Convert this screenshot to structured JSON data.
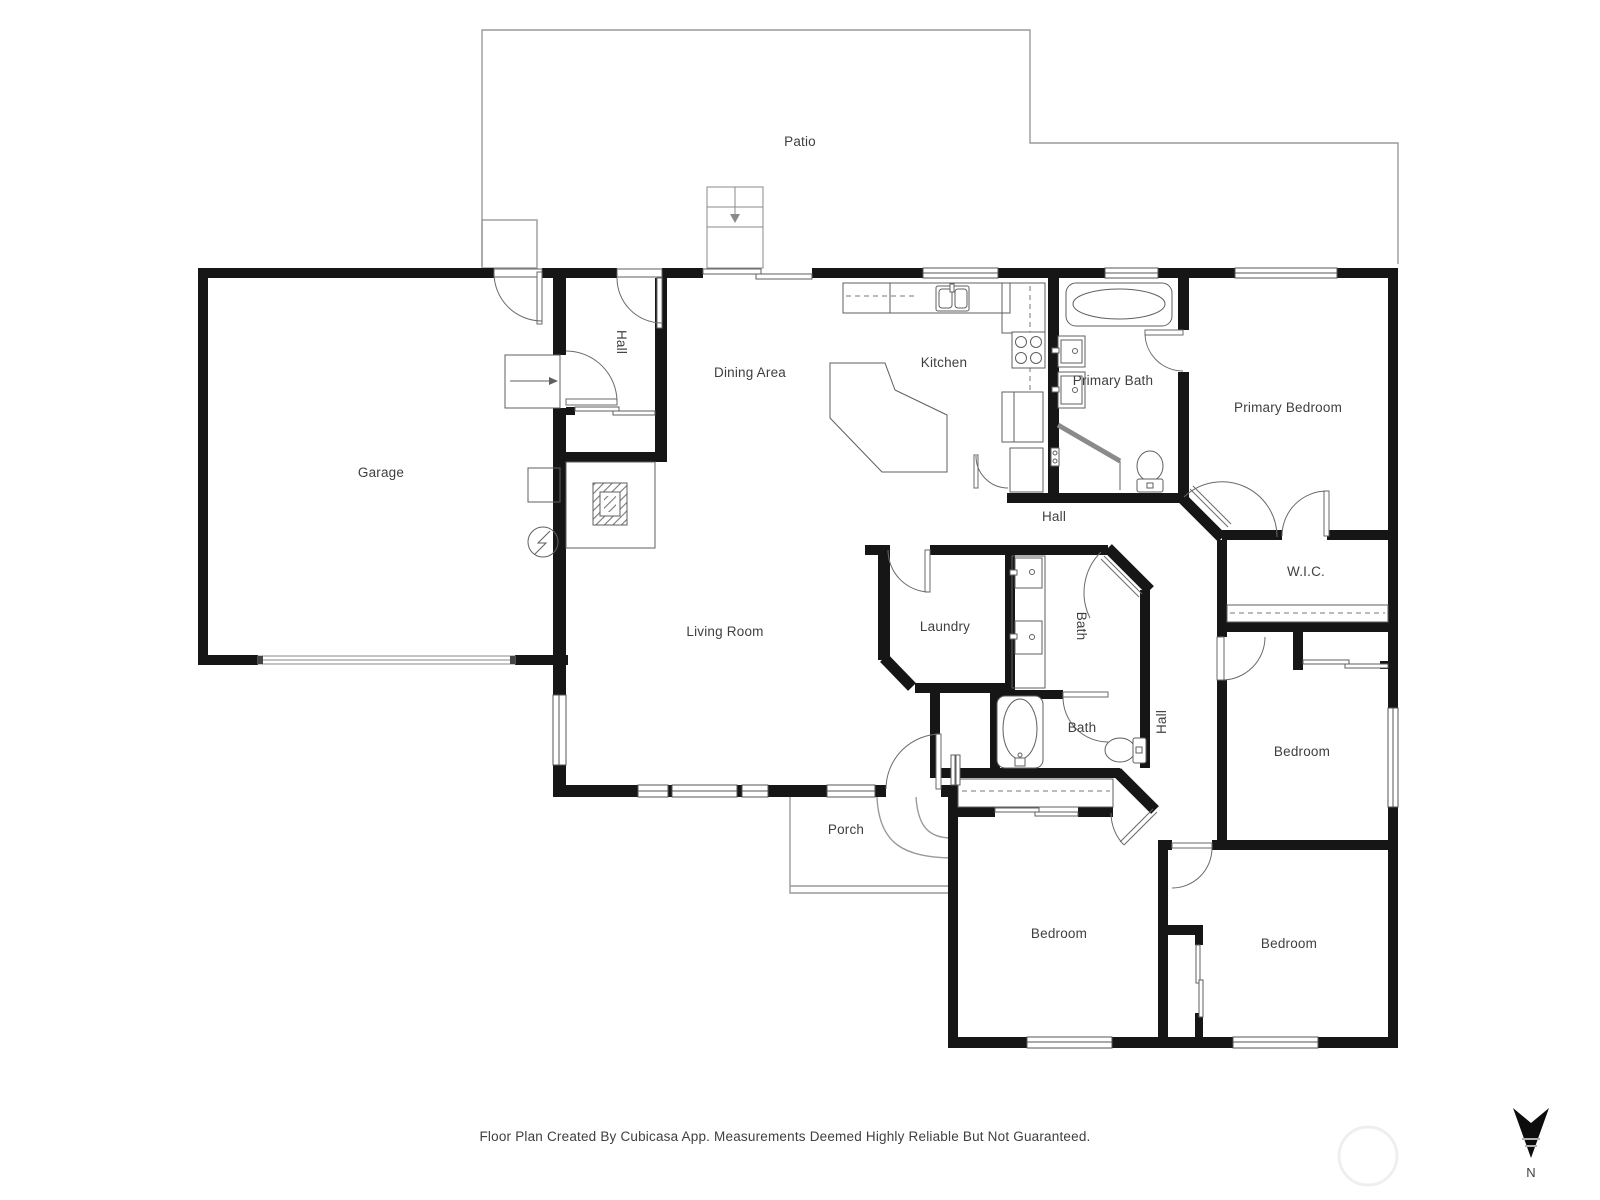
{
  "rooms": {
    "patio": "Patio",
    "garage": "Garage",
    "hall_entry": "Hall",
    "dining": "Dining Area",
    "kitchen": "Kitchen",
    "primary_bath": "Primary Bath",
    "primary_bedroom": "Primary Bedroom",
    "hall_center": "Hall",
    "wic": "W.I.C.",
    "laundry": "Laundry",
    "bath_upper": "Bath",
    "bath_lower": "Bath",
    "living": "Living Room",
    "hall_right": "Hall",
    "bedroom_right": "Bedroom",
    "porch": "Porch",
    "bedroom_bottom_left": "Bedroom",
    "bedroom_bottom_right": "Bedroom"
  },
  "footer": {
    "disclaimer": "Floor Plan Created By Cubicasa App. Measurements Deemed Highly Reliable But Not Guaranteed."
  },
  "compass": {
    "north_label": "N"
  }
}
